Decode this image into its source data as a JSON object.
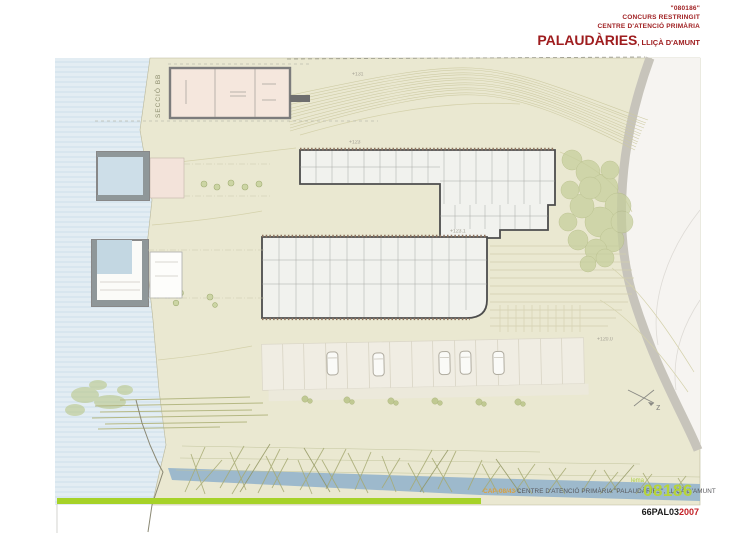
{
  "header": {
    "code": "\"080186\"",
    "competition": "CONCURS RESTRINGIT",
    "program": "CENTRE D'ATENCIÓ PRIMÀRIA",
    "project": "PALAUDÀRIES",
    "location": ", LLIÇÀ D'AMUNT"
  },
  "plan": {
    "section_label": "SECCIÓ BB",
    "north_label": "z",
    "levels": [
      {
        "text": "+131"
      },
      {
        "text": "+123"
      },
      {
        "text": "+123.1"
      },
      {
        "text": "+120.0"
      }
    ]
  },
  "footer": {
    "ref": "CAP-08/43",
    "title": "CENTRE D'ATENCIÓ PRIMÀRIA \"PALAUDÀRIES\", LLIÇÀ D'AMUNT",
    "lema_label": "lema",
    "lema_number": "08186",
    "sheet_code": "66PAL03",
    "year": "2007"
  },
  "colors": {
    "accent_red": "#9e1c1e",
    "bar_green": "#a6d228",
    "lema_green": "#b6d43a",
    "terrain": "#eae8d1",
    "water": "#e3edf3",
    "river": "#9db9cc",
    "road": "#c7c4bb"
  }
}
